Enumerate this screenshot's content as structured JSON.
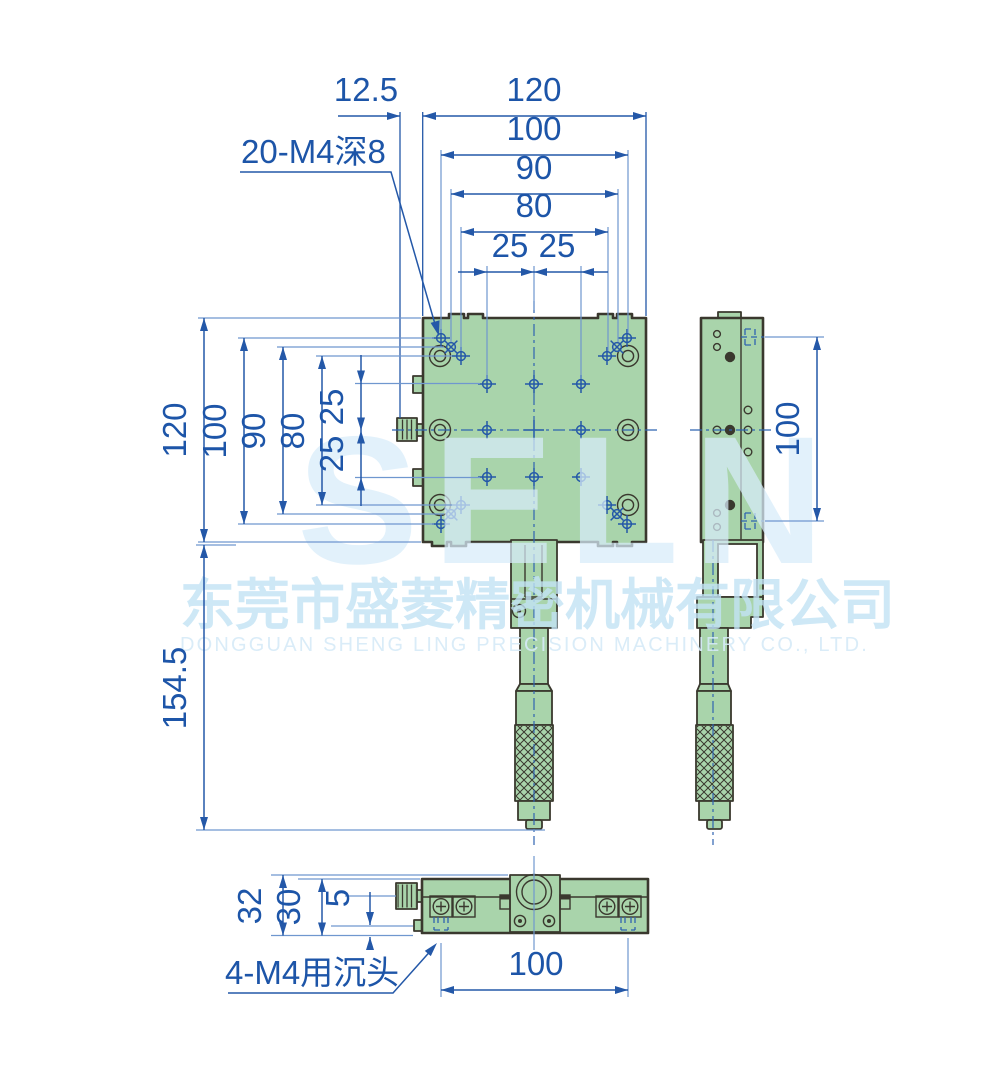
{
  "callouts": {
    "top": "20-M4深8",
    "bottom": "4-M4用沉头"
  },
  "dims": {
    "top_offset": "12.5",
    "top_width": "120",
    "top_100": "100",
    "top_90": "90",
    "top_80": "80",
    "top_25a": "25",
    "top_25b": "25",
    "left_120": "120",
    "left_100": "100",
    "left_90": "90",
    "left_80": "80",
    "left_25a": "25",
    "left_25b": "25",
    "left_total": "154.5",
    "right_100": "100",
    "bottom_32": "32",
    "bottom_30": "30",
    "bottom_5": "5",
    "bottom_100": "100"
  },
  "watermark": {
    "logo": "SELN",
    "company_cn": "东莞市盛菱精密机械有限公司",
    "company_en": "DONGGUAN SHENG LING PRECISION MACHINERY CO., LTD."
  },
  "colors": {
    "dimension_blue": "#2458a8",
    "body_green": "#a9d4ab",
    "outline_dark": "#3a382e",
    "watermark_blue": "#cfe8f7"
  }
}
